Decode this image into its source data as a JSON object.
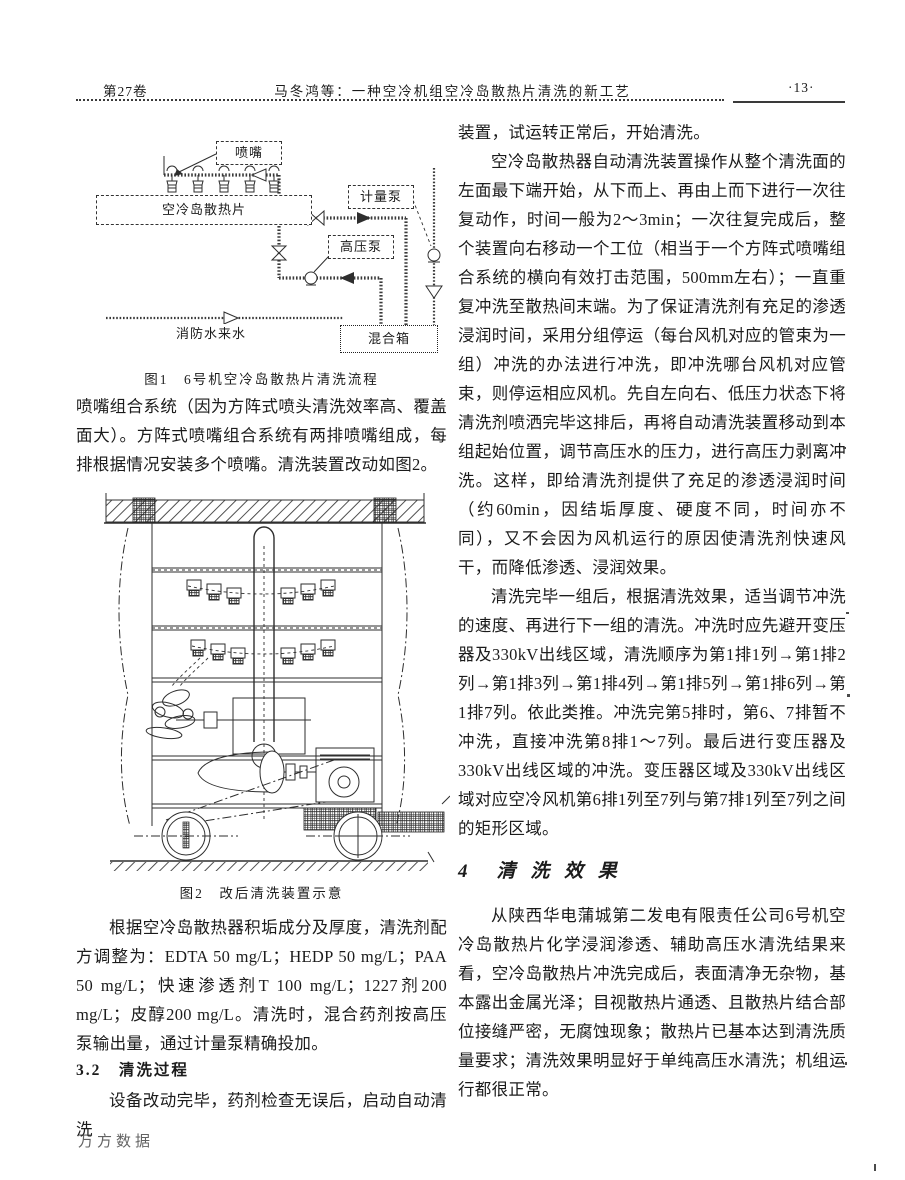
{
  "header": {
    "volume": "第27卷",
    "running_title": "马冬鸿等：一种空冷机组空冷岛散热片清洗的新工艺",
    "page_number": "·13·"
  },
  "left_column": {
    "figure1": {
      "caption": "图1　6号机空冷岛散热片清洗流程",
      "labels": {
        "nozzle": "喷嘴",
        "radiator": "空冷岛散热片",
        "metering_pump": "计量泵",
        "high_pressure_pump": "高压泵",
        "fire_water": "消防水来水",
        "mixing_tank": "混合箱"
      }
    },
    "para_nozzle_system": "喷嘴组合系统（因为方阵式喷头清洗效率高、覆盖面大）。方阵式喷嘴组合系统有两排喷嘴组成，每排根据情况安装多个喷嘴。清洗装置改动如图2。",
    "figure2": {
      "caption": "图2　改后清洗装置示意"
    },
    "para_recipe": "根据空冷岛散热器积垢成分及厚度，清洗剂配方调整为：EDTA 50 mg/L；HEDP 50 mg/L；PAA 50 mg/L；快速渗透剂T 100 mg/L；1227剂200 mg/L；皮醇200 mg/L。清洗时，混合药剂按高压泵输出量，通过计量泵精确投加。",
    "section_3_2": "3.2　清洗过程",
    "para_process_start": "设备改动完毕，药剂检查无误后，启动自动清洗",
    "watermark": "万方数据"
  },
  "right_column": {
    "para_continuation": "装置，试运转正常后，开始清洗。",
    "para_operation": "空冷岛散热器自动清洗装置操作从整个清洗面的左面最下端开始，从下而上、再由上而下进行一次往复动作，时间一般为2～3min；一次往复完成后，整个装置向右移动一个工位（相当于一个方阵式喷嘴组合系统的横向有效打击范围，500mm左右）；一直重复冲洗至散热间末端。为了保证清洗剂有充足的渗透浸润时间，采用分组停运（每台风机对应的管束为一组）冲洗的办法进行冲洗，即冲洗哪台风机对应管束，则停运相应风机。先自左向右、低压力状态下将清洗剂喷洒完毕这排后，再将自动清洗装置移动到本组起始位置，调节高压水的压力，进行高压力剥离冲洗。这样，即给清洗剂提供了充足的渗透浸润时间（约60min，因结垢厚度、硬度不同，时间亦不同），又不会因为风机运行的原因使清洗剂快速风干，而降低渗透、浸润效果。",
    "para_sequence": "清洗完毕一组后，根据清洗效果，适当调节冲洗的速度、再进行下一组的清洗。冲洗时应先避开变压器及330kV出线区域，清洗顺序为第1排1列→第1排2列→第1排3列→第1排4列→第1排5列→第1排6列→第1排7列。依此类推。冲洗完第5排时，第6、7排暂不冲洗，直接冲洗第8排1～7列。最后进行变压器及330kV出线区域的冲洗。变压器区域及330kV出线区域对应空冷风机第6排1列至7列与第7排1列至7列之间的矩形区域。",
    "section_4": "4　清 洗 效 果",
    "para_effect": "从陕西华电蒲城第二发电有限责任公司6号机空冷岛散热片化学浸润渗透、辅助高压水清洗结果来看，空冷岛散热片冲洗完成后，表面清净无杂物，基本露出金属光泽；目视散热片通透、且散热片结合部位接缝严密，无腐蚀现象；散热片已基本达到清洗质量要求；清洗效果明显好于单纯高压水清洗；机组运行都很正常。"
  }
}
